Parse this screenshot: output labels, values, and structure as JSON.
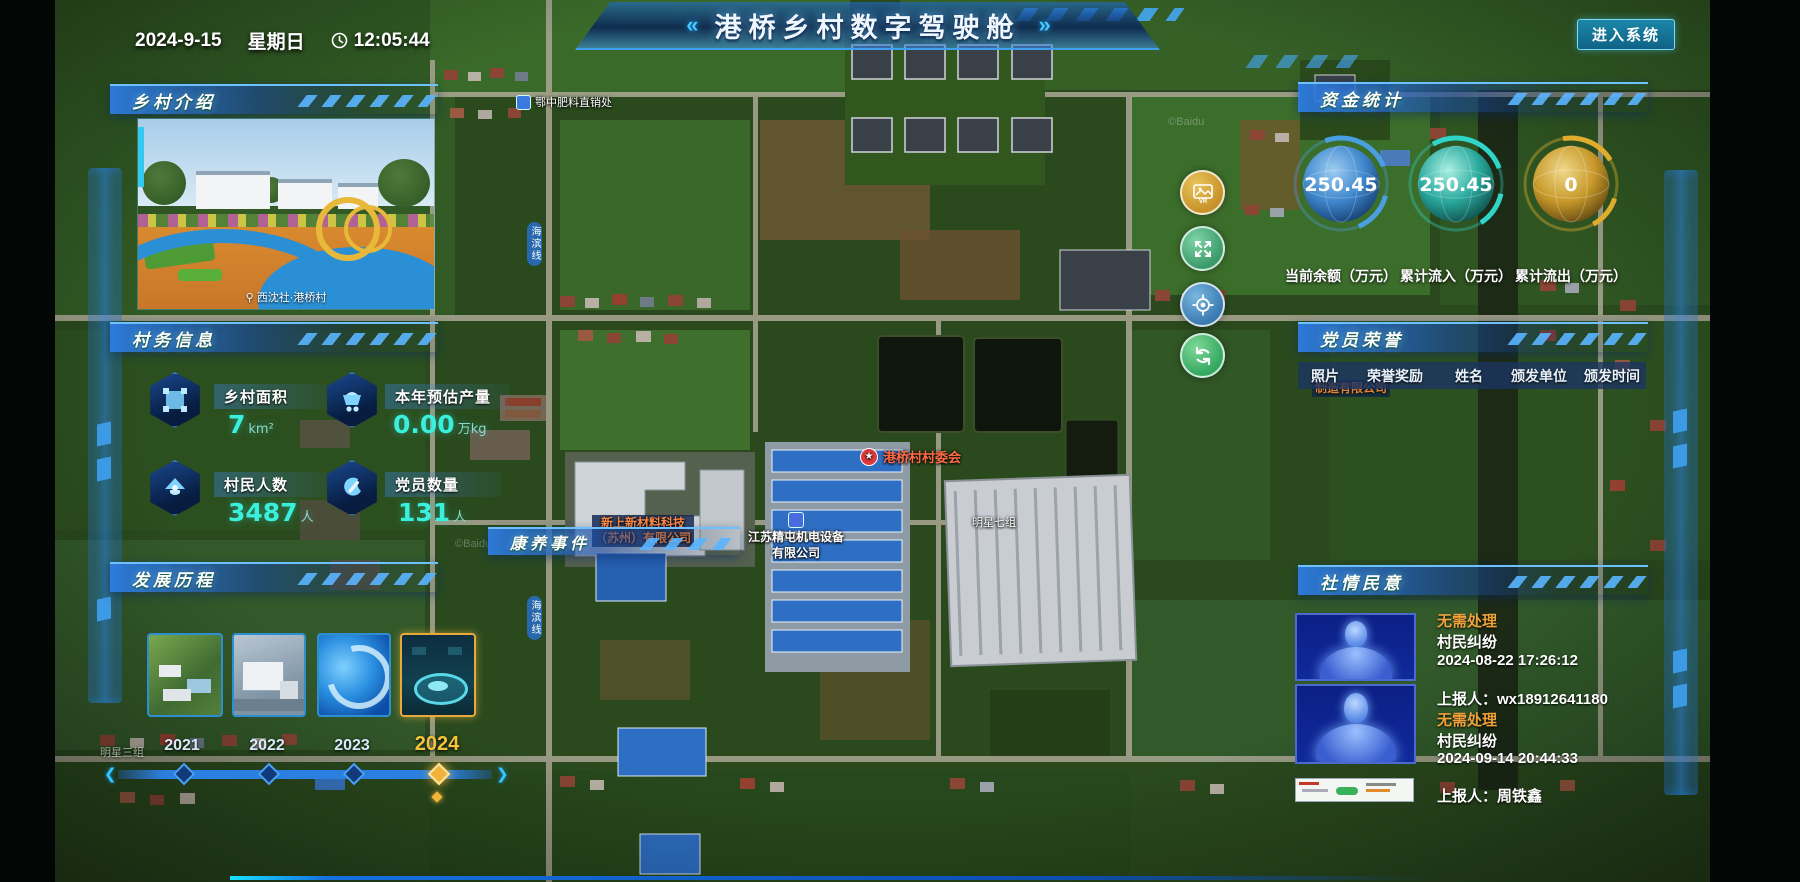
{
  "header": {
    "date": "2024-9-15",
    "weekday": "星期日",
    "time": "12:05:44",
    "title": "港桥乡村数字驾驶舱",
    "deco_left": "«",
    "deco_right": "»",
    "enter_button": "进入系统"
  },
  "panels": {
    "intro": {
      "title": "乡村介绍",
      "photo_caption": "西沈社·港桥村"
    },
    "affairs": {
      "title": "村务信息",
      "stats": [
        {
          "icon": "area-icon",
          "label": "乡村面积",
          "value": "7",
          "unit": "km²"
        },
        {
          "icon": "cart-icon",
          "label": "本年预估产量",
          "value": "0.00",
          "unit": "万kg"
        },
        {
          "icon": "people-icon",
          "label": "村民人数",
          "value": "3487",
          "unit": "人"
        },
        {
          "icon": "party-icon",
          "label": "党员数量",
          "value": "131",
          "unit": "人"
        }
      ]
    },
    "history": {
      "title": "发展历程",
      "years": [
        {
          "label": "2021",
          "active": false
        },
        {
          "label": "2022",
          "active": false
        },
        {
          "label": "2023",
          "active": false
        },
        {
          "label": "2024",
          "active": true
        }
      ]
    },
    "funds": {
      "title": "资金统计",
      "gauges": [
        {
          "value": "250.45",
          "label": "当前余额（万元）",
          "color": "#4a9fe3"
        },
        {
          "value": "250.45",
          "label": "累计流入（万元）",
          "color": "#2ed5c8"
        },
        {
          "value": "0",
          "label": "累计流出（万元）",
          "color": "#e0ac2e"
        }
      ]
    },
    "honors": {
      "title": "党员荣誉",
      "columns": [
        "照片",
        "荣誉奖励",
        "姓名",
        "颁发单位",
        "颁发时间"
      ]
    },
    "sentiment": {
      "title": "社情民意",
      "items": [
        {
          "status": "无需处理",
          "type": "村民纠纷",
          "time": "2024-08-22 17:26:12",
          "reporter_line": "上报人：wx18912641180"
        },
        {
          "status": "无需处理",
          "type": "村民纠纷",
          "time": "2024-09-14 20:44:33",
          "reporter_line": "上报人：周铁鑫"
        }
      ]
    },
    "events_bar": {
      "title": "康养事件"
    }
  },
  "map": {
    "labels": {
      "fertilizer_shop": "鄂中肥料直销处",
      "road_vertical": "海滨线",
      "village_committee": "港桥村村委会",
      "company1_line1": "江苏精屯机电设备",
      "company1_line2": "有限公司",
      "company2_line1": "新上新材料科技",
      "company2_line2": "（苏州）有限公司",
      "company3_partial": "制造有限公司",
      "group7": "明星七组",
      "group3": "明星三组",
      "watermark": "©Baidu"
    },
    "controls": [
      "vr-view-button",
      "fullscreen-button",
      "locate-button",
      "reset-view-button"
    ]
  }
}
